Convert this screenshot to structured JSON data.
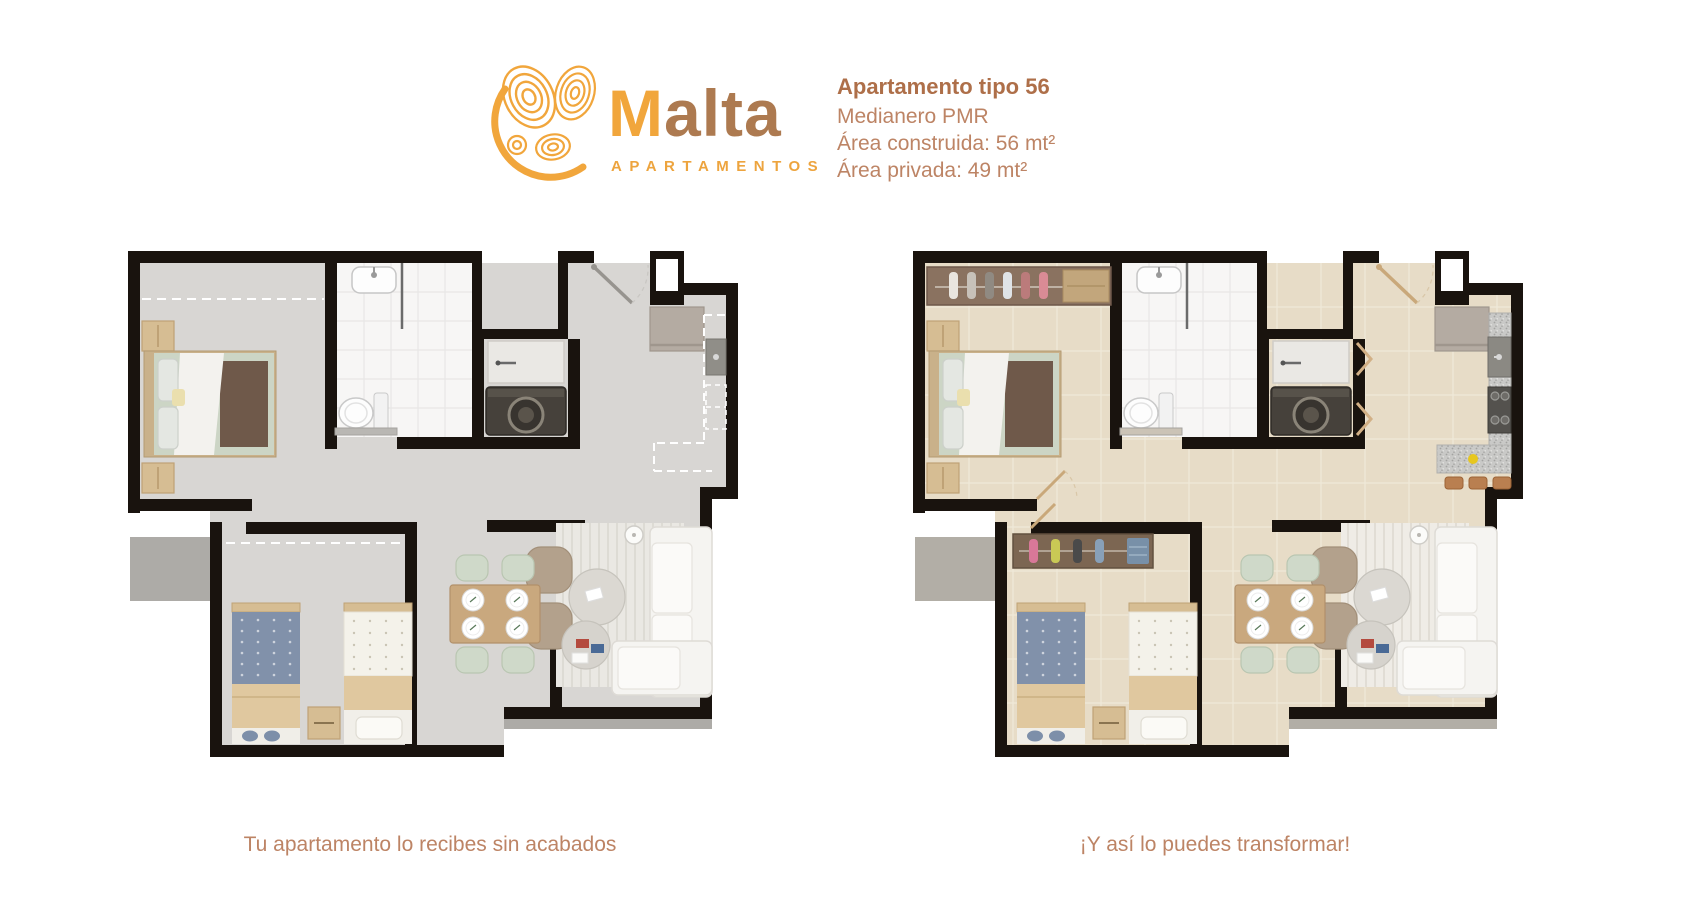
{
  "brand": {
    "wordmark_accent": "M",
    "wordmark_rest": "alta",
    "subtitle": "APARTAMENTOS",
    "logo_icon": "malta-swirl-icon"
  },
  "info": {
    "title": "Apartamento tipo 56",
    "subtitle": "Medianero PMR",
    "built_area": "Área construida: 56 mt²",
    "private_area": "Área privada: 49 mt²"
  },
  "captions": {
    "left": "Tu apartamento lo recibes sin acabados",
    "right": "¡Y así lo puedes transformar!"
  },
  "plans": {
    "left_state": "sin acabados",
    "right_state": "con acabados"
  },
  "colors": {
    "accent_orange": "#f1a63c",
    "accent_brown": "#ad7a50",
    "text_brown": "#bd8465",
    "title_brown": "#ae6f49",
    "wall_black": "#19130e",
    "shell_floor": "#d8d6d3",
    "finished_floor": "#e7dcc7",
    "bathroom_tile": "#f7f6f5",
    "counter_granite": "#c9c9c7"
  }
}
